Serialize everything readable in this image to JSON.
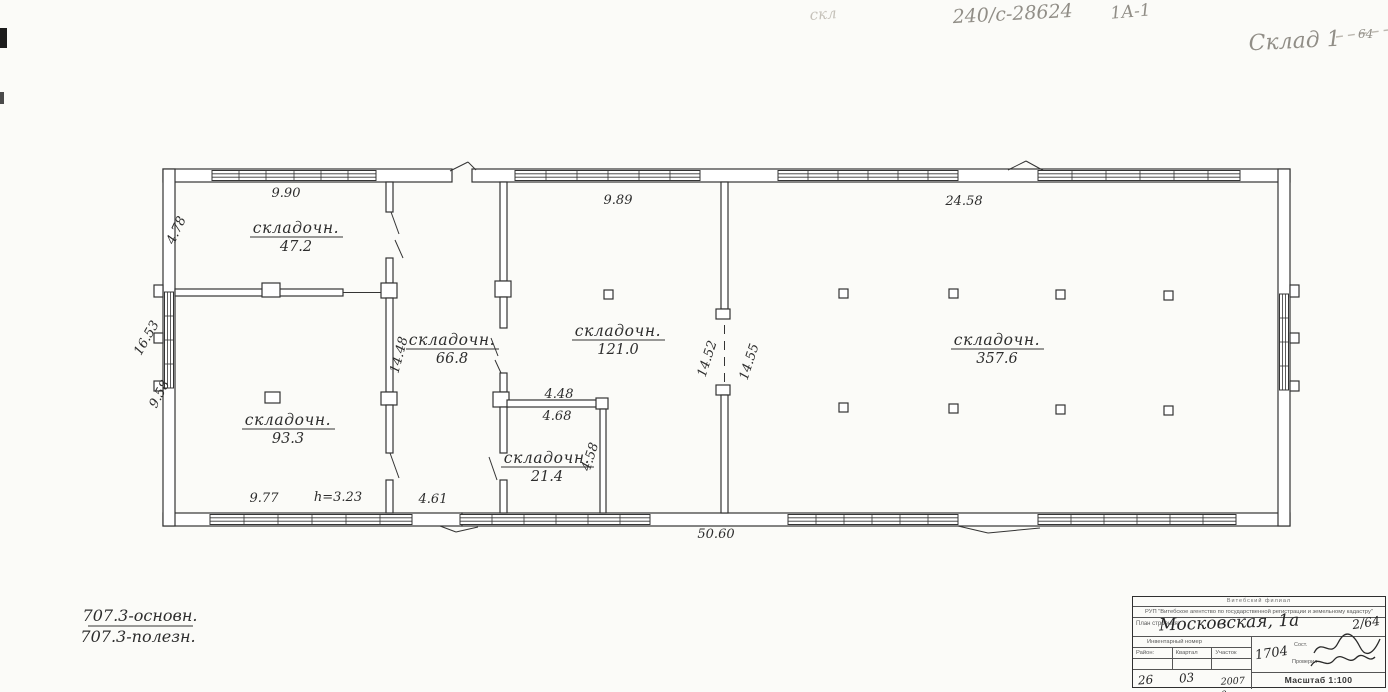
{
  "pencil": {
    "faint_note": "скл",
    "doc_number": "240/с-28624",
    "code": "1А-1",
    "title": "Склад 1",
    "page": "64"
  },
  "plan": {
    "rooms": [
      {
        "label": "складочн.",
        "area": "47.2"
      },
      {
        "label": "складочн.",
        "area": "93.3"
      },
      {
        "label": "складочн.",
        "area": "66.8"
      },
      {
        "label": "складочн.",
        "area": "121.0"
      },
      {
        "label": "складочн.",
        "area": "21.4"
      },
      {
        "label": "складочн.",
        "area": "357.6"
      }
    ],
    "dimensions": {
      "top_left": "9.90",
      "left_upper": "4.78",
      "left_outer": "16.53",
      "left_lower": "9.58",
      "bottom_left": "9.77",
      "height_note": "h=3.23",
      "bottom_corridor": "4.61",
      "mid_top": "9.89",
      "small_top": "4.48",
      "small_inner": "4.68",
      "small_right": "4.58",
      "corridor_vert": "14.48",
      "mid_vert_left": "14.52",
      "mid_vert_right": "14.55",
      "right_top": "24.58",
      "bottom_total": "50.60"
    },
    "totals": {
      "line1": "707.3-основн.",
      "line2": "707.3-полезн."
    }
  },
  "stamp": {
    "org_line1": "Витебский филиал",
    "org_line2": "РУП \"Витебское агентство по государственной регистрации и земельному кадастру\"",
    "plan_label": "План строения:",
    "address": "Московская, 1а",
    "sheet_no": "2/64",
    "inv_label": "Инвентарный номер",
    "col_district": "Район:",
    "col_block": "Квартал",
    "col_plot": "Участок",
    "handwritten_no": "1704",
    "compiled_label": "Сост.",
    "checked_label": "Проверил",
    "date_day": "26",
    "date_month": "03",
    "date_year": "2007 г.",
    "scale": "Масштаб 1:100"
  }
}
